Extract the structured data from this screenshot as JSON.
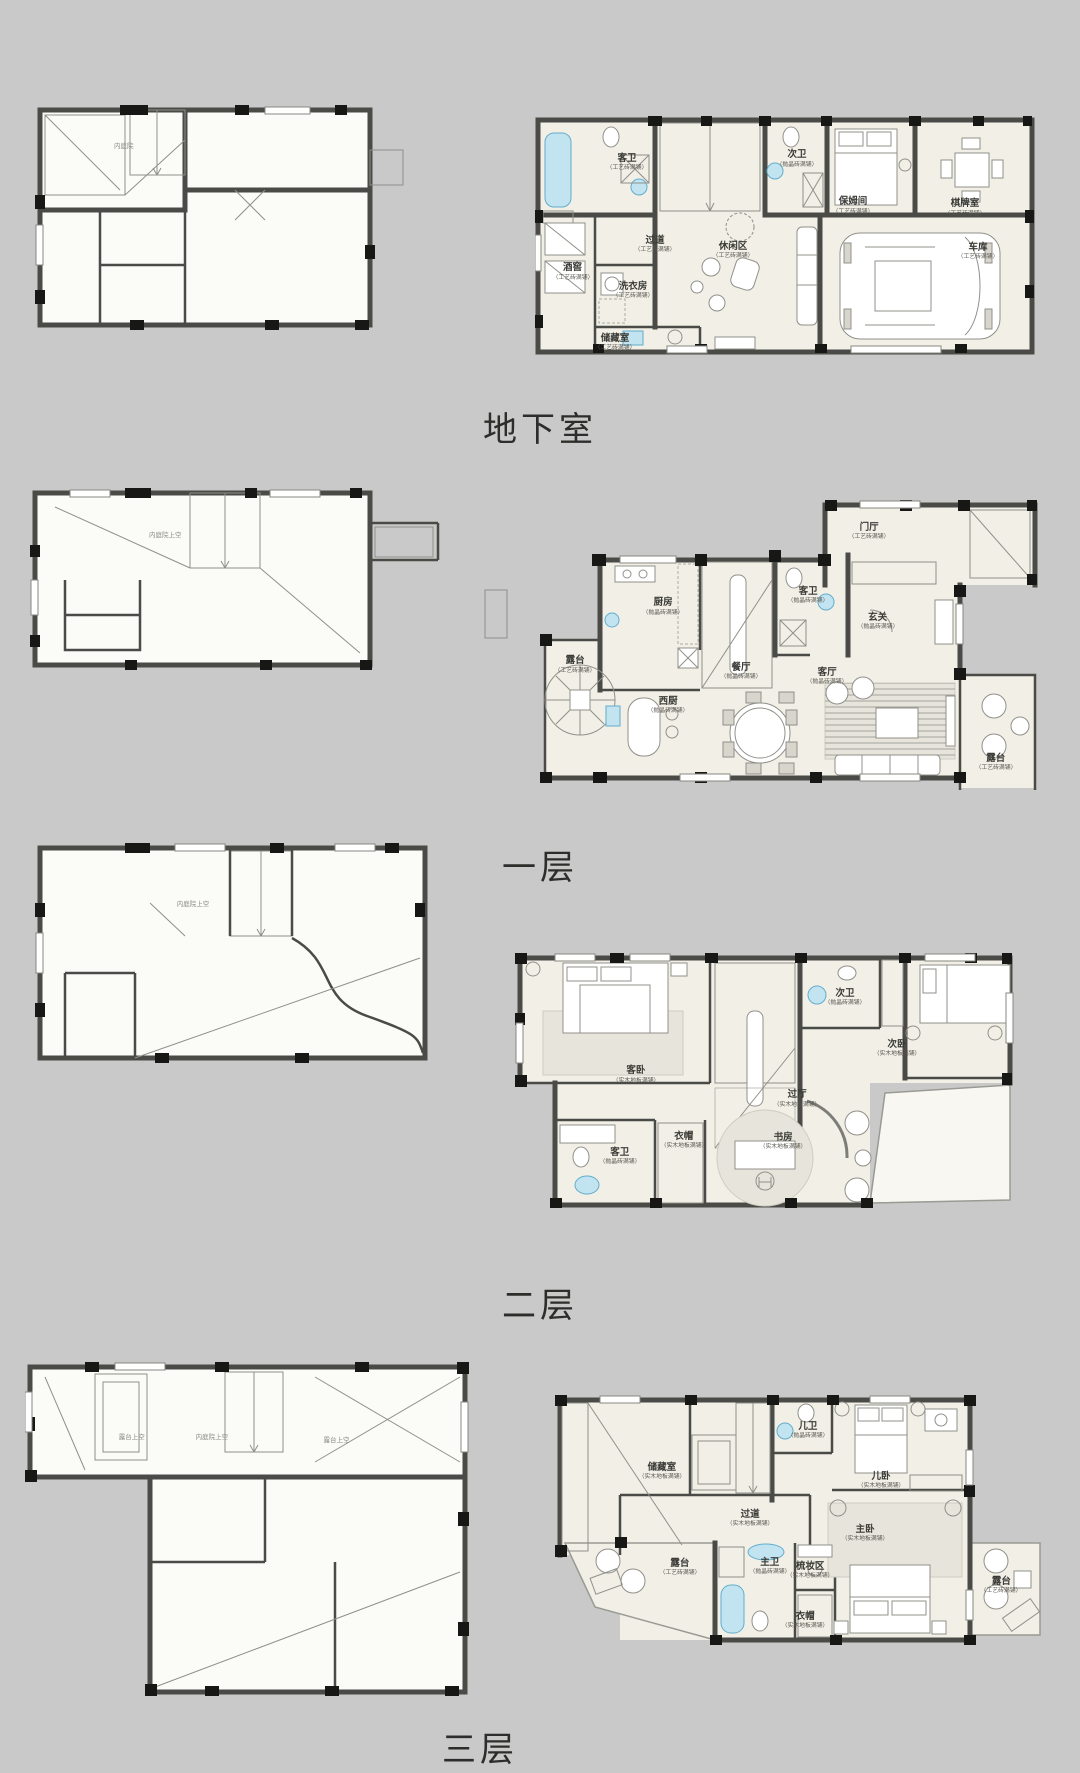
{
  "page": {
    "background": "#c9c9c9",
    "type": "residential-floorplan-sheet"
  },
  "palette": {
    "wall": "#4a4a47",
    "column": "#171716",
    "furnished_floor": "#f1efe6",
    "blank_floor": "#fbfbf8",
    "water_fixture": "#c2e4f1",
    "label_ink": "#3a3a36"
  },
  "sections": [
    {
      "id": "basement",
      "title": "地下室",
      "left_plan": {
        "kind": "structural-plan",
        "notes": [
          {
            "text": "内庭院",
            "x": 24,
            "y": 21
          }
        ]
      },
      "right_plan": {
        "kind": "furnished-plan",
        "rooms": [
          {
            "name": "客卫",
            "sub": "（工艺砖满铺）",
            "x": 18.4,
            "y": 20
          },
          {
            "name": "次卫",
            "sub": "（抛晶砖满铺）",
            "x": 52.4,
            "y": 18.5
          },
          {
            "name": "保姆间",
            "sub": "（工艺砖满铺）",
            "x": 63.6,
            "y": 38
          },
          {
            "name": "棋牌室",
            "sub": "（工艺砖满铺）",
            "x": 86,
            "y": 38.8
          },
          {
            "name": "过道",
            "sub": "（工艺砖满铺）",
            "x": 24,
            "y": 54
          },
          {
            "name": "休闲区",
            "sub": "（工艺砖满铺）",
            "x": 39.6,
            "y": 56.5
          },
          {
            "name": "车库",
            "sub": "（工艺砖满铺）",
            "x": 88.6,
            "y": 57
          },
          {
            "name": "酒窖",
            "sub": "（工艺砖满铺）",
            "x": 7.5,
            "y": 65.5
          },
          {
            "name": "洗衣房",
            "sub": "（工艺砖满铺）",
            "x": 19.6,
            "y": 73.3
          },
          {
            "name": "储藏室",
            "sub": "（工艺砖满铺）",
            "x": 16,
            "y": 95
          }
        ]
      }
    },
    {
      "id": "floor1",
      "title": "一层",
      "left_plan": {
        "kind": "structural-plan",
        "notes": [
          {
            "text": "内庭院上空",
            "x": 33,
            "y": 23
          }
        ]
      },
      "right_plan": {
        "kind": "furnished-plan",
        "rooms": [
          {
            "name": "门厅",
            "sub": "（工艺砖满铺）",
            "x": 69.5,
            "y": 11
          },
          {
            "name": "厨房",
            "sub": "（抛晶砖满铺）",
            "x": 32.7,
            "y": 37
          },
          {
            "name": "客卫",
            "sub": "（抛晶砖满铺）",
            "x": 58.6,
            "y": 33
          },
          {
            "name": "玄关",
            "sub": "（抛晶砖满铺）",
            "x": 71,
            "y": 42
          },
          {
            "name": "露台",
            "sub": "（工艺砖满铺）",
            "x": 17,
            "y": 57
          },
          {
            "name": "西厨",
            "sub": "（抛晶砖满铺）",
            "x": 33.6,
            "y": 71
          },
          {
            "name": "餐厅",
            "sub": "（抛晶砖满铺）",
            "x": 46.6,
            "y": 59.3
          },
          {
            "name": "客厅",
            "sub": "（抛晶砖满铺）",
            "x": 62,
            "y": 61
          },
          {
            "name": "露台",
            "sub": "（工艺砖满铺）",
            "x": 92.1,
            "y": 90.7
          }
        ]
      }
    },
    {
      "id": "floor2",
      "title": "二层",
      "left_plan": {
        "kind": "structural-plan",
        "notes": [
          {
            "text": "内庭院上空",
            "x": 39,
            "y": 27
          }
        ]
      },
      "right_plan": {
        "kind": "furnished-plan",
        "rooms": [
          {
            "name": "客卧",
            "sub": "（实木地板满铺）",
            "x": 27.1,
            "y": 48
          },
          {
            "name": "次卫",
            "sub": "（抛晶砖满铺）",
            "x": 67.3,
            "y": 17.6
          },
          {
            "name": "次卧",
            "sub": "（实木地板满铺）",
            "x": 77.3,
            "y": 37.6
          },
          {
            "name": "过厅",
            "sub": "（实木地板满铺）",
            "x": 58.1,
            "y": 57.3
          },
          {
            "name": "客卫",
            "sub": "（抛晶砖满铺）",
            "x": 24,
            "y": 80
          },
          {
            "name": "衣帽",
            "sub": "（实木地板满铺）",
            "x": 36.3,
            "y": 73.7
          },
          {
            "name": "书房",
            "sub": "（实木地板满铺）",
            "x": 55.4,
            "y": 74.1
          }
        ]
      }
    },
    {
      "id": "floor3",
      "title": "三层",
      "left_plan": {
        "kind": "structural-plan",
        "notes": [
          {
            "text": "露台上空",
            "x": 24,
            "y": 22
          },
          {
            "text": "内庭院上空",
            "x": 42,
            "y": 22
          },
          {
            "text": "露台上空",
            "x": 70,
            "y": 23
          }
        ]
      },
      "right_plan": {
        "kind": "furnished-plan",
        "rooms": [
          {
            "name": "储藏室",
            "sub": "（实木地板满铺）",
            "x": 29.7,
            "y": 30.8
          },
          {
            "name": "儿卫",
            "sub": "（抛晶砖满铺）",
            "x": 56.5,
            "y": 14.4
          },
          {
            "name": "儿卧",
            "sub": "（实木地板满铺）",
            "x": 69.9,
            "y": 34.4
          },
          {
            "name": "过道",
            "sub": "（实木地板满铺）",
            "x": 45.9,
            "y": 49.6
          },
          {
            "name": "主卧",
            "sub": "（实木地板满铺）",
            "x": 67,
            "y": 55.6
          },
          {
            "name": "露台",
            "sub": "（工艺砖满铺）",
            "x": 33,
            "y": 69.2
          },
          {
            "name": "主卫",
            "sub": "（抛晶砖满铺）",
            "x": 49.5,
            "y": 68.8
          },
          {
            "name": "梳妆区",
            "sub": "（实木地板满铺）",
            "x": 56.9,
            "y": 70.4
          },
          {
            "name": "衣帽",
            "sub": "（实木地板满铺）",
            "x": 56,
            "y": 90.4
          },
          {
            "name": "露台",
            "sub": "（工艺砖满铺）",
            "x": 92,
            "y": 76.4
          }
        ]
      }
    }
  ]
}
